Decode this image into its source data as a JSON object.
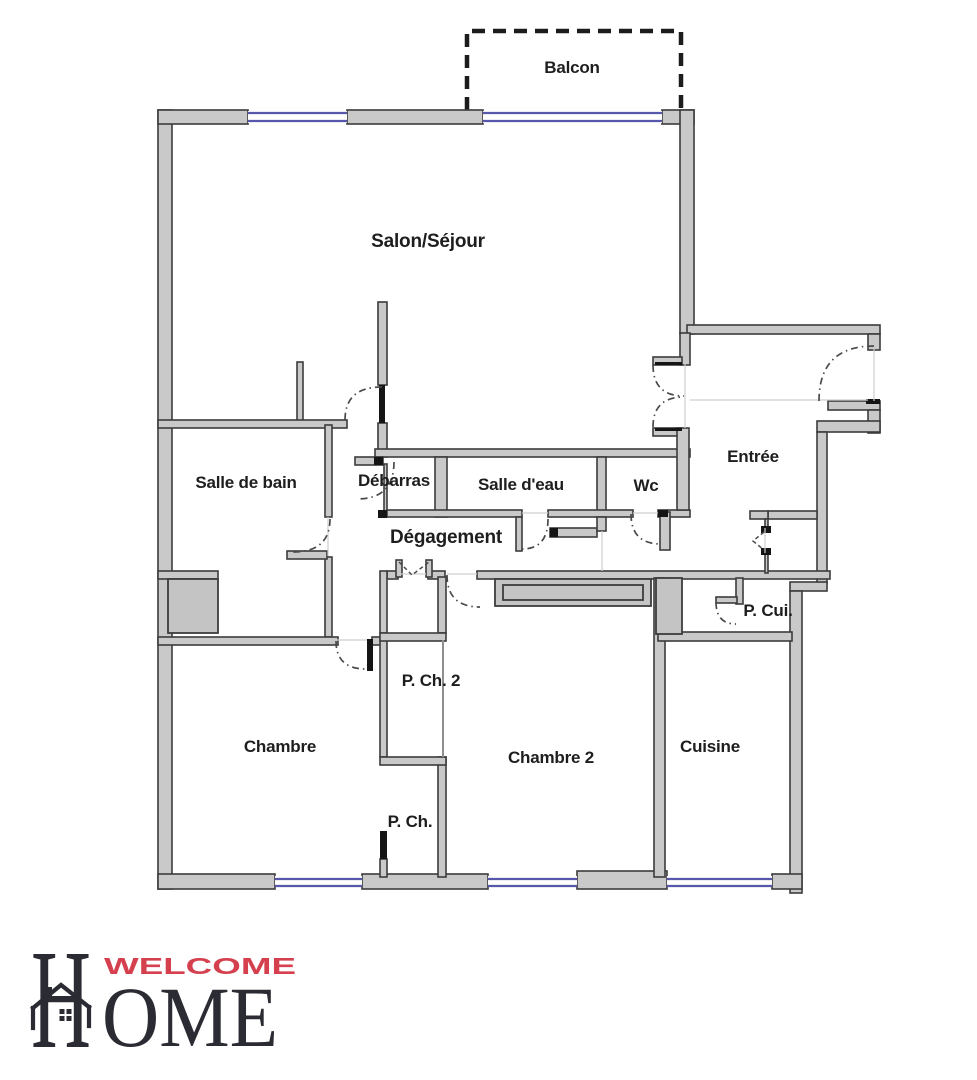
{
  "floor_plan": {
    "rooms": {
      "balcon": {
        "label": "Balcon"
      },
      "salon": {
        "label": "Salon/Séjour"
      },
      "salle_de_bain": {
        "label": "Salle de bain"
      },
      "debarras": {
        "label": "Débarras"
      },
      "salle_deau": {
        "label": "Salle d'eau"
      },
      "wc": {
        "label": "Wc"
      },
      "entree": {
        "label": "Entrée"
      },
      "degagement": {
        "label": "Dégagement"
      },
      "p_cui": {
        "label": "P. Cui."
      },
      "p_ch_2": {
        "label": "P. Ch. 2"
      },
      "chambre": {
        "label": "Chambre"
      },
      "chambre_2": {
        "label": "Chambre 2"
      },
      "cuisine": {
        "label": "Cuisine"
      },
      "p_ch": {
        "label": "P. Ch."
      }
    },
    "colors": {
      "wall_fill": "#c9c9c9",
      "wall_stroke": "#3c3c3c",
      "window_blue": "#5757ab",
      "door_leaf_black": "#151515",
      "door_arc_dash": "#4a4a4a",
      "balcony_dash": "#1c1c1c",
      "label_text": "#1e1e1e",
      "logo_red": "#d5404e",
      "logo_dark": "#2b2b33"
    }
  },
  "logo": {
    "welcome": "WELCOME",
    "home_initial": "H",
    "home_rest": "OME"
  }
}
